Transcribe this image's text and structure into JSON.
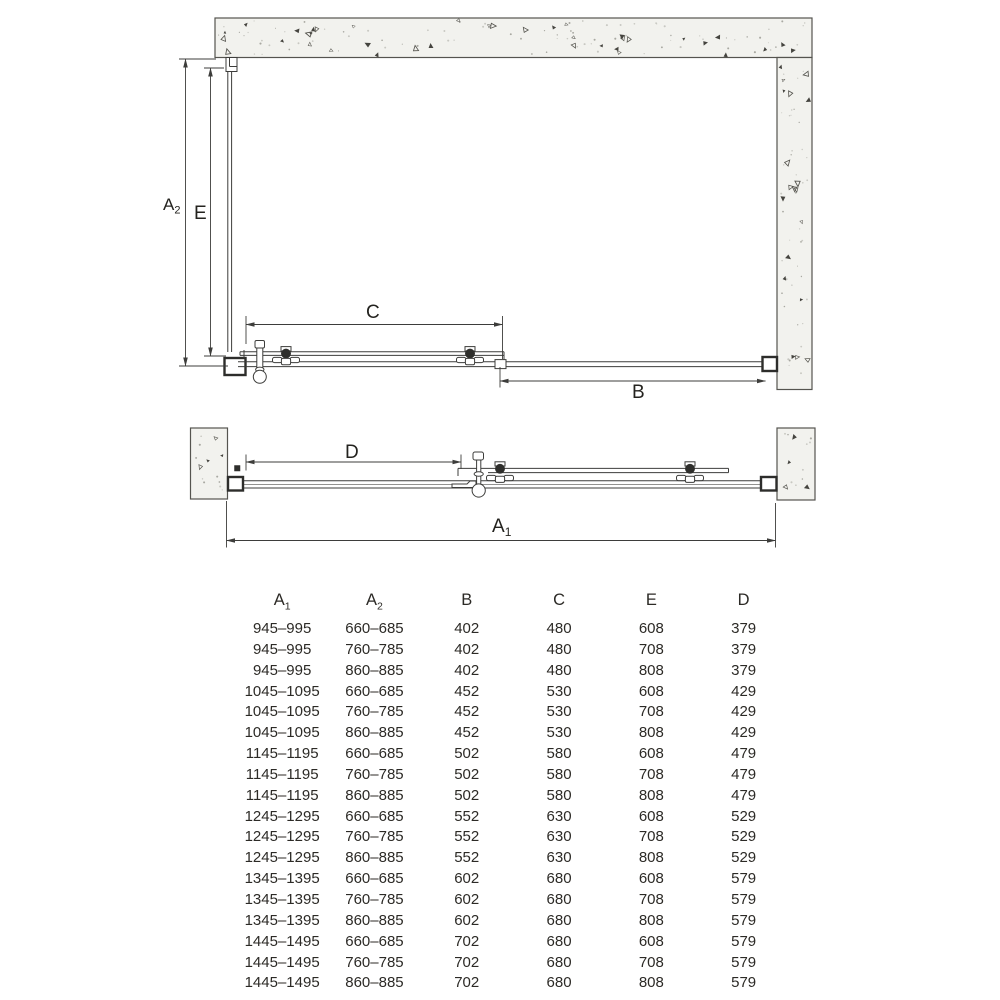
{
  "page": {
    "background": "#ffffff",
    "line_color": "#3d3d3b",
    "wall_fill": "#f2f2ee",
    "text_color": "#2c2a26"
  },
  "plan_view": {
    "description": "top view of corner shower enclosure with sliding door",
    "labels": {
      "a2": {
        "base": "A",
        "sub": "2"
      },
      "e": {
        "base": "E",
        "sub": ""
      },
      "c": {
        "base": "C",
        "sub": ""
      },
      "b": {
        "base": "B",
        "sub": ""
      }
    }
  },
  "front_view": {
    "description": "top view of sliding door unit between two walls",
    "labels": {
      "d": {
        "base": "D",
        "sub": ""
      },
      "a1": {
        "base": "A",
        "sub": "1"
      }
    }
  },
  "table": {
    "headers": [
      {
        "base": "A",
        "sub": "1"
      },
      {
        "base": "A",
        "sub": "2"
      },
      {
        "base": "B",
        "sub": ""
      },
      {
        "base": "C",
        "sub": ""
      },
      {
        "base": "E",
        "sub": ""
      },
      {
        "base": "D",
        "sub": ""
      }
    ],
    "rows": [
      [
        "945–995",
        "660–685",
        "402",
        "480",
        "608",
        "379"
      ],
      [
        "945–995",
        "760–785",
        "402",
        "480",
        "708",
        "379"
      ],
      [
        "945–995",
        "860–885",
        "402",
        "480",
        "808",
        "379"
      ],
      [
        "1045–1095",
        "660–685",
        "452",
        "530",
        "608",
        "429"
      ],
      [
        "1045–1095",
        "760–785",
        "452",
        "530",
        "708",
        "429"
      ],
      [
        "1045–1095",
        "860–885",
        "452",
        "530",
        "808",
        "429"
      ],
      [
        "1145–1195",
        "660–685",
        "502",
        "580",
        "608",
        "479"
      ],
      [
        "1145–1195",
        "760–785",
        "502",
        "580",
        "708",
        "479"
      ],
      [
        "1145–1195",
        "860–885",
        "502",
        "580",
        "808",
        "479"
      ],
      [
        "1245–1295",
        "660–685",
        "552",
        "630",
        "608",
        "529"
      ],
      [
        "1245–1295",
        "760–785",
        "552",
        "630",
        "708",
        "529"
      ],
      [
        "1245–1295",
        "860–885",
        "552",
        "630",
        "808",
        "529"
      ],
      [
        "1345–1395",
        "660–685",
        "602",
        "680",
        "608",
        "579"
      ],
      [
        "1345–1395",
        "760–785",
        "602",
        "680",
        "708",
        "579"
      ],
      [
        "1345–1395",
        "860–885",
        "602",
        "680",
        "808",
        "579"
      ],
      [
        "1445–1495",
        "660–685",
        "702",
        "680",
        "608",
        "579"
      ],
      [
        "1445–1495",
        "760–785",
        "702",
        "680",
        "708",
        "579"
      ],
      [
        "1445–1495",
        "860–885",
        "702",
        "680",
        "808",
        "579"
      ]
    ]
  }
}
